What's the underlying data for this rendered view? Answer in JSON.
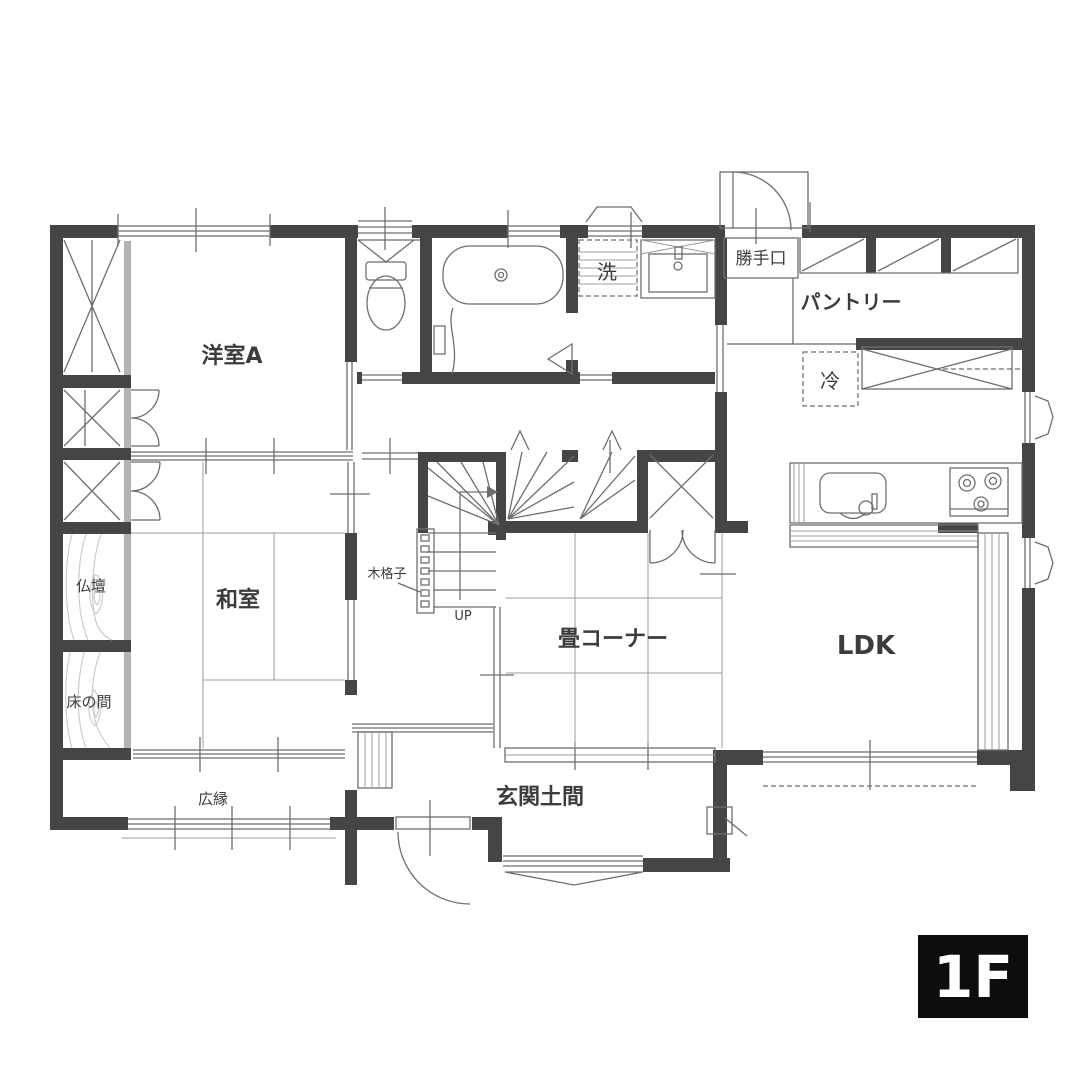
{
  "floor_badge": "1F",
  "rooms": {
    "yoshitsu_a": "洋室A",
    "washitsu": "和室",
    "butsudan": "仏壇",
    "tokonoma": "床の間",
    "hiroen": "広縁",
    "genkan_doma": "玄関土間",
    "tatami_corner": "畳コーナー",
    "ldk": "LDK",
    "pantry": "パントリー",
    "katteguchi": "勝手口",
    "laundry": "洗",
    "fridge": "冷",
    "wood_lattice": "木格子",
    "stairs_up": "UP"
  },
  "colors": {
    "wall": "#454545",
    "line": "#6e6e6e",
    "lline": "#9c9c9c",
    "grain": "#cccccc",
    "text": "#3c3c3c",
    "badge_bg": "#0d0d0d",
    "badge_text": "#ffffff",
    "background": "#ffffff"
  }
}
